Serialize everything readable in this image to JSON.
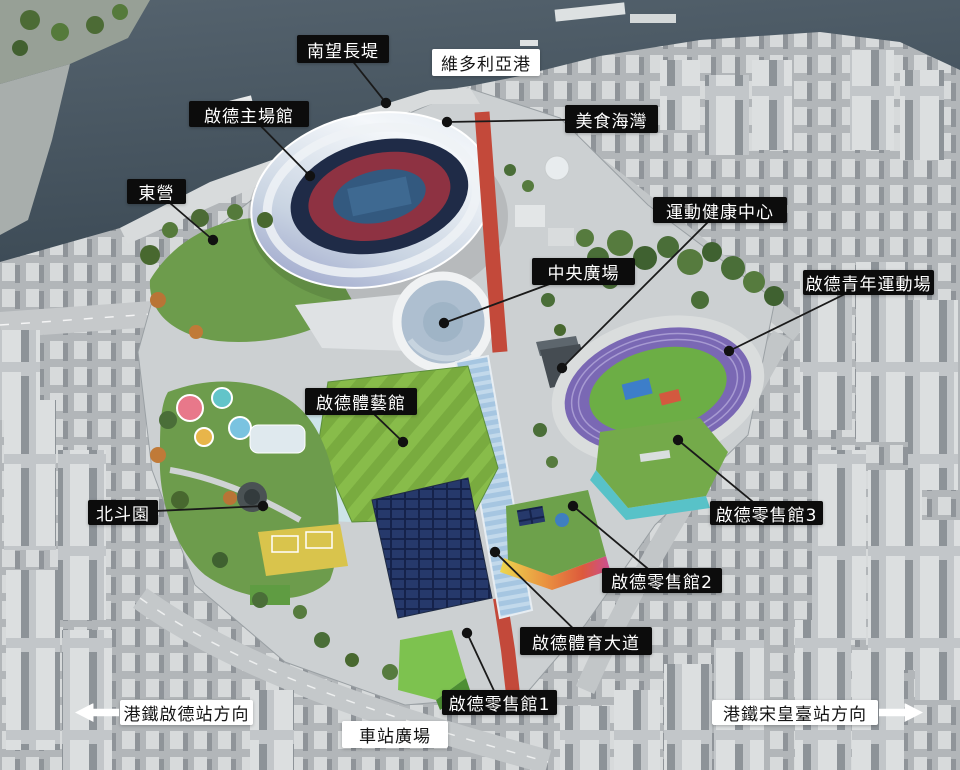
{
  "colors": {
    "label_dark_bg": "#0c0c0c",
    "label_dark_text": "#ffffff",
    "label_light_bg": "#ffffff",
    "label_light_text": "#141414",
    "leader_line": "#1a1a1a",
    "leader_dot": "#111111",
    "water": "#46545f",
    "avenue_red": "#c3493a",
    "lawn_green": "#79ab3f",
    "retail3_teal": "#58c2c8"
  },
  "annotations": [
    {
      "text": "南望長堤",
      "style": "dark",
      "box": {
        "x": 297,
        "y": 35,
        "w": 92,
        "h": 28
      },
      "dot": {
        "x": 386,
        "y": 103
      }
    },
    {
      "text": "維多利亞港",
      "style": "light",
      "box": {
        "x": 432,
        "y": 49,
        "w": 108,
        "h": 27
      }
    },
    {
      "text": "啟德主場館",
      "style": "dark",
      "box": {
        "x": 189,
        "y": 101,
        "w": 120,
        "h": 26
      },
      "dot": {
        "x": 310,
        "y": 176
      }
    },
    {
      "text": "美食海灣",
      "style": "dark",
      "box": {
        "x": 565,
        "y": 105,
        "w": 93,
        "h": 28
      },
      "dot": {
        "x": 447,
        "y": 122
      }
    },
    {
      "text": "東營",
      "style": "dark",
      "box": {
        "x": 127,
        "y": 179,
        "w": 59,
        "h": 25
      },
      "dot": {
        "x": 213,
        "y": 240
      }
    },
    {
      "text": "運動健康中心",
      "style": "dark",
      "box": {
        "x": 653,
        "y": 197,
        "w": 134,
        "h": 26
      },
      "dot": {
        "x": 562,
        "y": 368
      }
    },
    {
      "text": "中央廣場",
      "style": "dark",
      "box": {
        "x": 532,
        "y": 258,
        "w": 103,
        "h": 27
      },
      "dot": {
        "x": 444,
        "y": 323
      }
    },
    {
      "text": "啟德青年運動場",
      "style": "dark",
      "box": {
        "x": 803,
        "y": 270,
        "w": 131,
        "h": 25
      },
      "dot": {
        "x": 729,
        "y": 351
      }
    },
    {
      "text": "啟德體藝館",
      "style": "dark",
      "box": {
        "x": 305,
        "y": 388,
        "w": 112,
        "h": 27
      },
      "dot": {
        "x": 403,
        "y": 442
      }
    },
    {
      "text": "北斗園",
      "style": "dark",
      "box": {
        "x": 88,
        "y": 500,
        "w": 70,
        "h": 25
      },
      "dot": {
        "x": 263,
        "y": 506
      }
    },
    {
      "text": "啟德零售館3",
      "style": "dark",
      "box": {
        "x": 710,
        "y": 501,
        "w": 113,
        "h": 24
      },
      "dot": {
        "x": 678,
        "y": 440
      }
    },
    {
      "text": "啟德零售館2",
      "style": "dark",
      "box": {
        "x": 602,
        "y": 568,
        "w": 120,
        "h": 25
      },
      "dot": {
        "x": 573,
        "y": 506
      }
    },
    {
      "text": "啟德體育大道",
      "style": "dark",
      "box": {
        "x": 520,
        "y": 627,
        "w": 132,
        "h": 28
      },
      "dot": {
        "x": 495,
        "y": 552
      }
    },
    {
      "text": "啟德零售館1",
      "style": "dark",
      "box": {
        "x": 442,
        "y": 690,
        "w": 115,
        "h": 25
      },
      "dot": {
        "x": 467,
        "y": 633
      }
    },
    {
      "text": "港鐵啟德站方向",
      "style": "light",
      "arrow": "left",
      "box": {
        "x": 120,
        "y": 700,
        "w": 133,
        "h": 25
      }
    },
    {
      "text": "車站廣場",
      "style": "light",
      "box": {
        "x": 342,
        "y": 721,
        "w": 106,
        "h": 27
      }
    },
    {
      "text": "港鐵宋皇臺站方向",
      "style": "light",
      "arrow": "right",
      "box": {
        "x": 712,
        "y": 700,
        "w": 166,
        "h": 25
      }
    }
  ]
}
